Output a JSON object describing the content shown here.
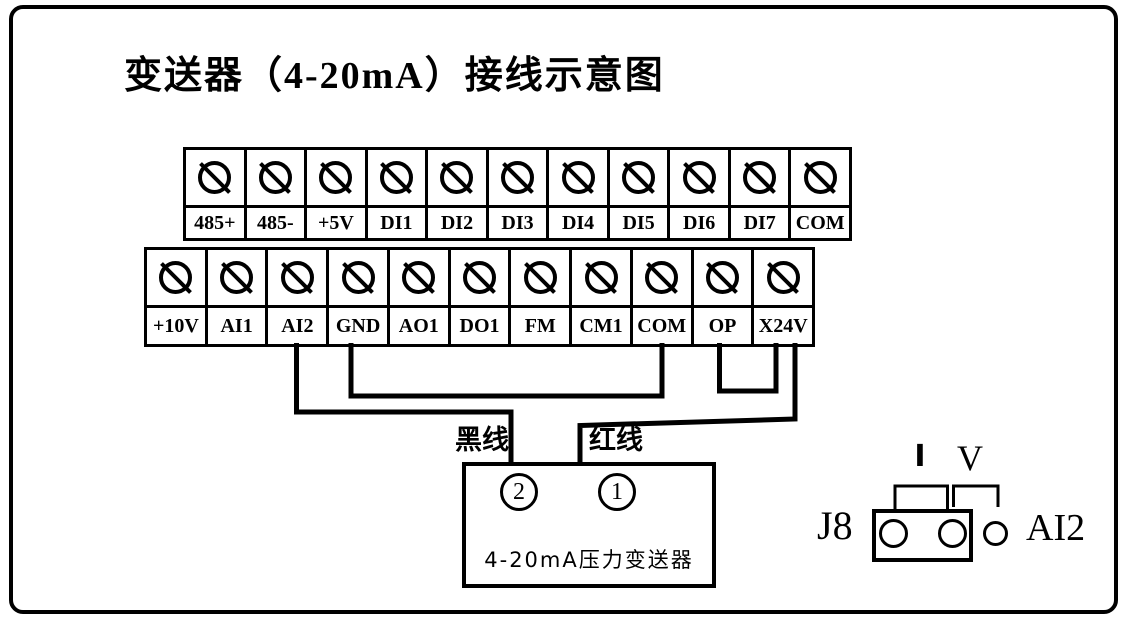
{
  "title": "变送器（4-20mA）接线示意图",
  "strips": {
    "top": {
      "labels": [
        "485+",
        "485-",
        "+5V",
        "DI1",
        "DI2",
        "DI3",
        "DI4",
        "DI5",
        "DI6",
        "DI7",
        "COM"
      ]
    },
    "bottom": {
      "labels": [
        "+10V",
        "AI1",
        "AI2",
        "GND",
        "AO1",
        "DO1",
        "FM",
        "CM1",
        "COM",
        "OP",
        "X24V"
      ]
    }
  },
  "wiring": {
    "black_wire": {
      "label": "黑线",
      "from": "AI2",
      "to": "transmitter-terminal-2"
    },
    "red_wire": {
      "label": "红线",
      "from": "X24V",
      "to": "transmitter-terminal-1"
    },
    "jumper_gnd_com": {
      "from": "GND",
      "to": "COM"
    },
    "jumper_op_x24v": {
      "from": "OP",
      "to": "X24V"
    }
  },
  "transmitter": {
    "terminal_left": "2",
    "terminal_right": "1",
    "caption": "4-20mA压力变送器"
  },
  "jumper_detail": {
    "connector_label": "J8",
    "current_mark": "I",
    "voltage_mark": "V",
    "channel_label": "AI2"
  },
  "colors": {
    "line": "#000000",
    "background": "#ffffff"
  }
}
